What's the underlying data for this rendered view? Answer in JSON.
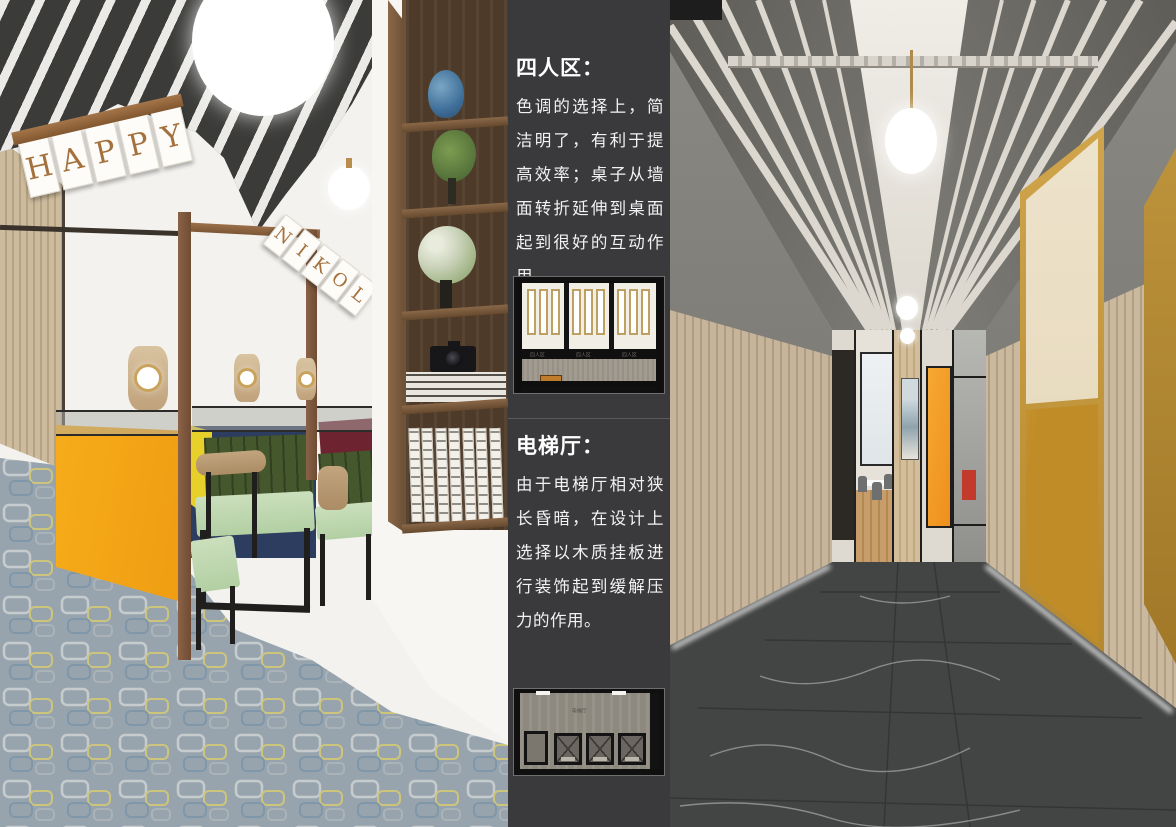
{
  "annotation_panel": {
    "background_color": "#3a3a3c",
    "text_color": "#ffffff",
    "sections": [
      {
        "heading": "四人区：",
        "body": "色调的选择上，简洁明了，有利于提高效率；桌子从墙面转折延伸到桌面起到很好的互动作用。",
        "plan": {
          "bay_labels": [
            "四人区",
            "四人区",
            "四人区"
          ]
        }
      },
      {
        "heading": "电梯厅：",
        "body": "由于电梯厅相对狭长昏暗，在设计上选择以木质挂板进行装饰起到缓解压力的作用。",
        "plan": {
          "room_label": "电梯厅"
        }
      }
    ]
  },
  "left_photo": {
    "happy_sign": {
      "letters": [
        "H",
        "A",
        "P",
        "P",
        "Y"
      ]
    },
    "second_sign": {
      "letters": [
        "N",
        "I",
        "K",
        "O",
        "L"
      ]
    },
    "colors": {
      "partition_orange": "#f2a41c",
      "backrest_green": "#45572d",
      "seat_sage": "#bed6af",
      "panel_navy": "#2c3d60",
      "panel_yellow": "#e8d02a",
      "panel_maroon": "#6e2330",
      "carpet_gray": "#98a4ad"
    }
  },
  "right_photo": {
    "colors": {
      "wood_wall": "#bfab90",
      "marble_floor": "#434544",
      "elevator_gold": "#c9992f",
      "partition_orange": "#f49b28"
    }
  }
}
